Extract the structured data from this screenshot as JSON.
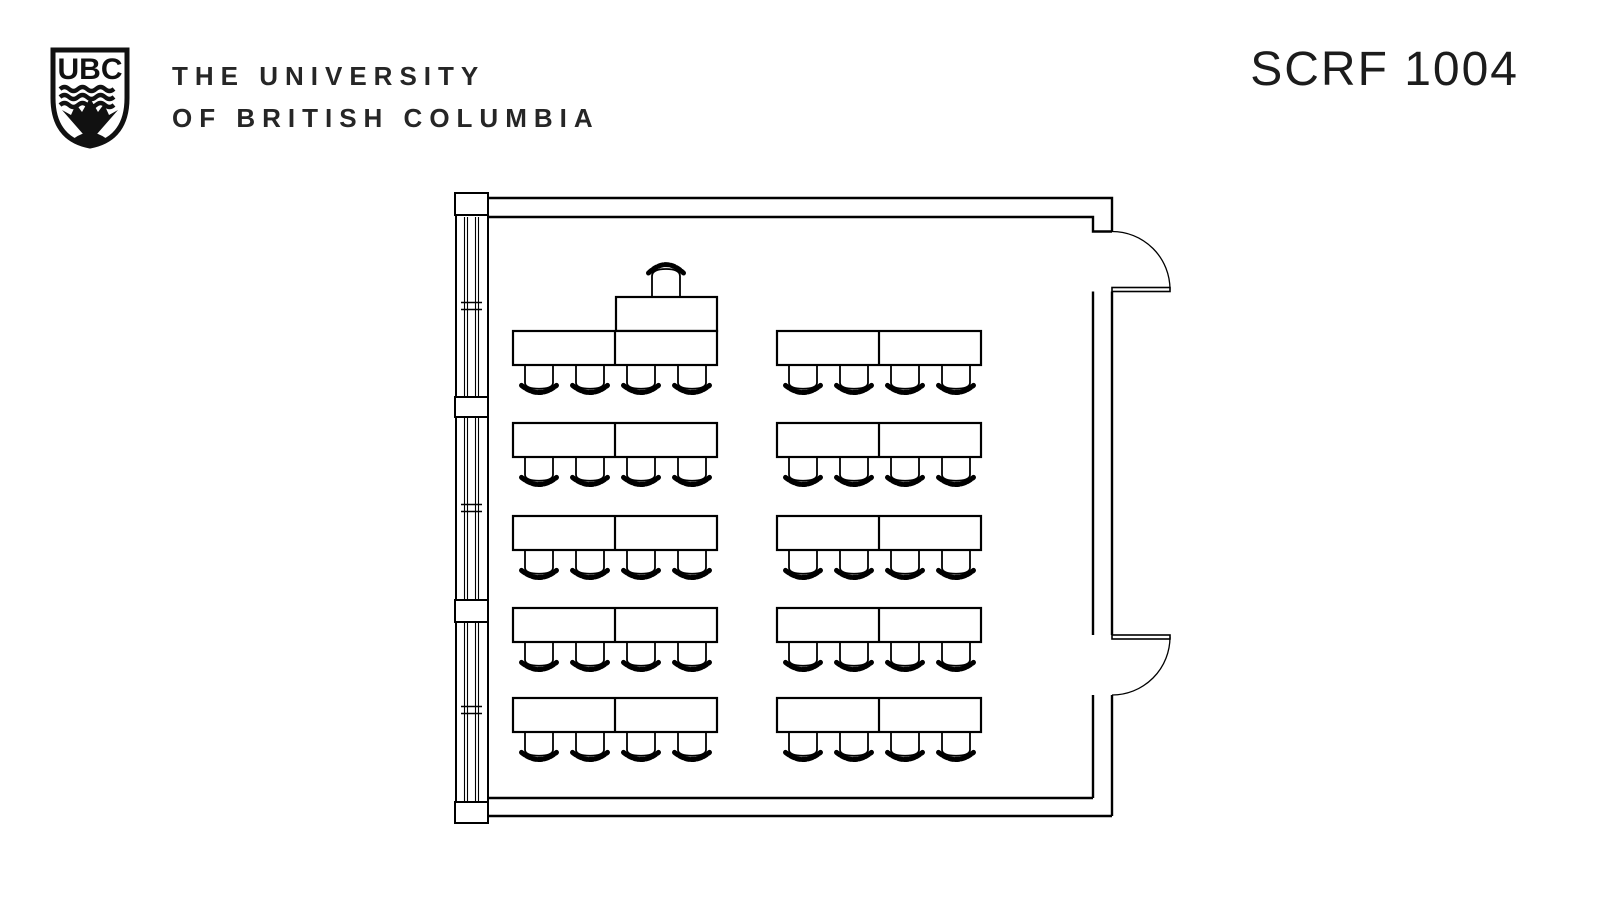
{
  "header": {
    "logo_text": "UBC",
    "university_line1": "THE UNIVERSITY",
    "university_line2": "OF BRITISH COLUMBIA",
    "room_code": "SCRF 1004"
  },
  "colors": {
    "ink": "#111111",
    "background": "#ffffff"
  },
  "floorplan": {
    "rows": 5,
    "table_groups_per_row": 2,
    "seats_per_table_group": 4,
    "student_seats_total": 40,
    "instructor_seats": 1,
    "geometry": {
      "row_table_y": [
        331,
        423,
        516,
        608,
        698
      ],
      "group_x": [
        513,
        777
      ],
      "table": {
        "width": 204,
        "height": 34
      },
      "chair": {
        "width": 34,
        "height": 34,
        "offsets": [
          9,
          60,
          111,
          162
        ]
      },
      "instructor_table": {
        "x": 616,
        "y": 297,
        "width": 101,
        "height": 34
      },
      "instructor_chair": {
        "x": 649,
        "y": 257,
        "width": 34,
        "height": 40
      }
    }
  }
}
